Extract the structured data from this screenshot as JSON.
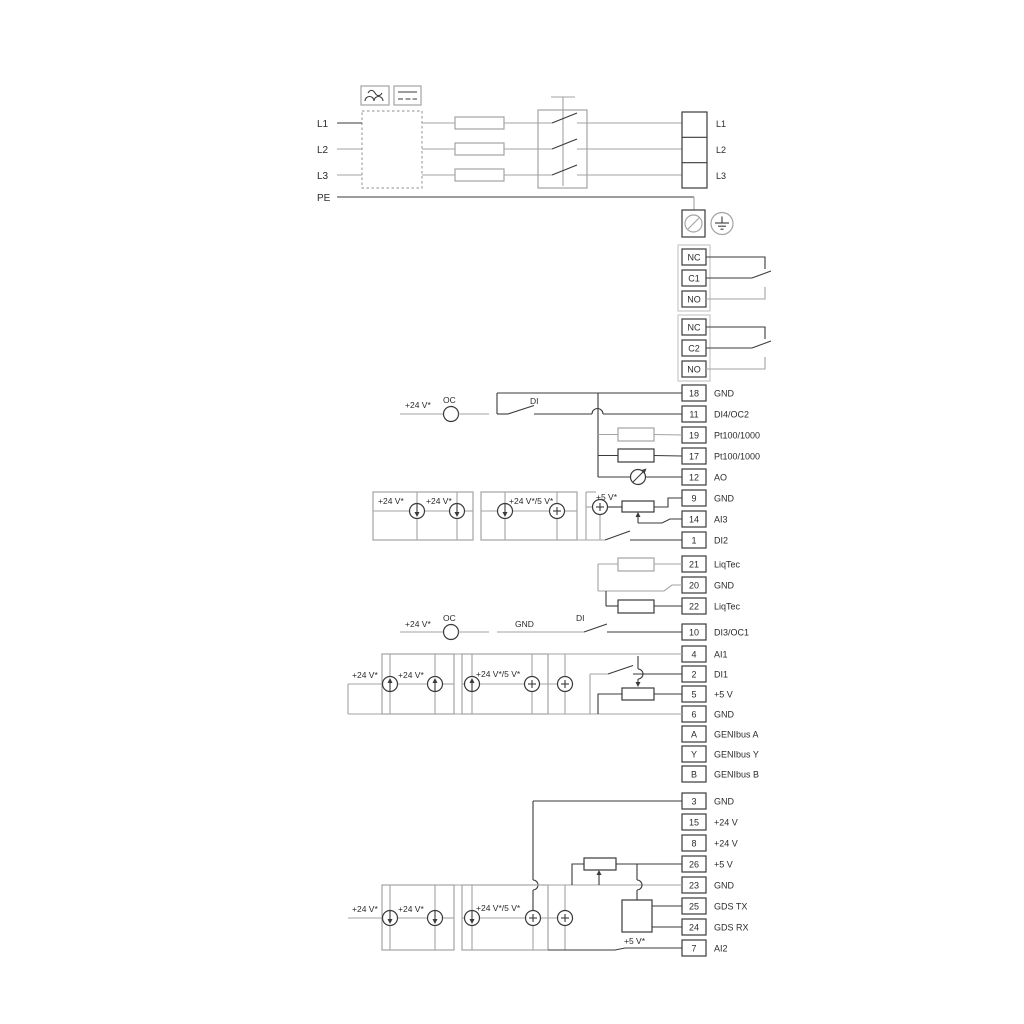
{
  "power": {
    "in": [
      "L1",
      "L2",
      "L3",
      "PE"
    ],
    "out": [
      "L1",
      "L2",
      "L3"
    ]
  },
  "relays": {
    "k1": [
      "NC",
      "C1",
      "NO"
    ],
    "k2": [
      "NC",
      "C2",
      "NO"
    ]
  },
  "io1": [
    {
      "num": "18",
      "label": "GND"
    },
    {
      "num": "11",
      "label": "DI4/OC2"
    },
    {
      "num": "19",
      "label": "Pt100/1000"
    },
    {
      "num": "17",
      "label": "Pt100/1000"
    },
    {
      "num": "12",
      "label": "AO"
    },
    {
      "num": "9",
      "label": "GND"
    },
    {
      "num": "14",
      "label": "AI3"
    },
    {
      "num": "1",
      "label": "DI2"
    }
  ],
  "liqtec": [
    {
      "num": "21",
      "label": "LiqTec"
    },
    {
      "num": "20",
      "label": "GND"
    },
    {
      "num": "22",
      "label": "LiqTec"
    }
  ],
  "io2": [
    {
      "num": "10",
      "label": "DI3/OC1"
    },
    {
      "num": "4",
      "label": "AI1"
    },
    {
      "num": "2",
      "label": "DI1"
    },
    {
      "num": "5",
      "label": "+5 V"
    },
    {
      "num": "6",
      "label": "GND"
    },
    {
      "num": "A",
      "label": "GENIbus A"
    },
    {
      "num": "Y",
      "label": "GENIbus Y"
    },
    {
      "num": "B",
      "label": "GENIbus B"
    }
  ],
  "io3": [
    {
      "num": "3",
      "label": "GND"
    },
    {
      "num": "15",
      "label": "+24 V"
    },
    {
      "num": "8",
      "label": "+24 V"
    },
    {
      "num": "26",
      "label": "+5 V"
    },
    {
      "num": "23",
      "label": "GND"
    },
    {
      "num": "25",
      "label": "GDS TX"
    },
    {
      "num": "24",
      "label": "GDS RX"
    },
    {
      "num": "7",
      "label": "AI2"
    }
  ],
  "schematic_labels": {
    "v24": "+24 V*",
    "v24_5": "+24 V*/5 V*",
    "v5": "+5 V*",
    "oc": "OC",
    "di": "DI",
    "gnd": "GND"
  },
  "colors": {
    "wire_dark": "#3a3a3a",
    "wire_gray": "#a3a3a3",
    "background": "#ffffff"
  }
}
